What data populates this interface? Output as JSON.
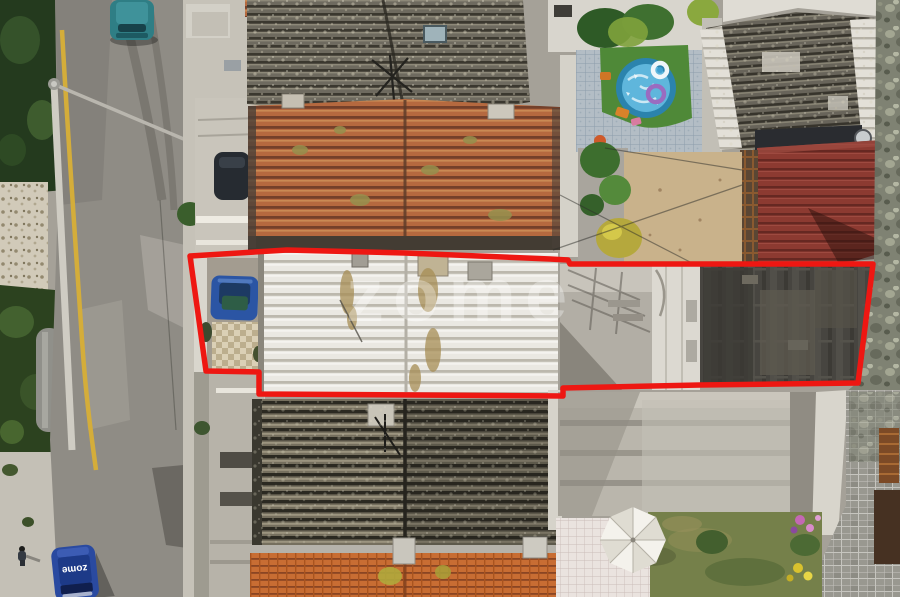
{
  "meta": {
    "kind": "aerial-drone-photo",
    "width": 900,
    "height": 597
  },
  "watermark": {
    "text": "zome",
    "color": "#ffffff",
    "opacity": 0.32
  },
  "branding": {
    "vehicle_label": "zome"
  },
  "boundary": {
    "color": "#ee1712",
    "points": "190,256 287,250 405,253 550,259 568,260 570,264 873,264 858,383 700,385 563,388 563,396 259,394 259,372 206,371"
  },
  "palette": {
    "road": "#8f8c85",
    "yellow_road_line": "#d4ad3a",
    "roof_terracotta": "#b5693f",
    "roof_terracotta_bright": "#c86d33",
    "roof_dark_corrugated": "#5f5b51",
    "roof_white_corrugated": "#eae8e2",
    "roof_charcoal_flat": "#474540",
    "roof_red_metal": "#8c3a31",
    "pool_blue": "#3f9fc8",
    "turf_green": "#4f8938",
    "lawn_green": "#75804a",
    "stone_wall": "#7f8273",
    "granite_pavers": "#999890",
    "teal_car": "#2f7e85",
    "branded_car_blue": "#2a4aa0",
    "boundary_red": "#ee1712"
  },
  "scene": {
    "description": "Aerial drone view of a row of terraced houses with a red property-boundary outline highlighting a white corrugated roof, courtyard and rear flat roof",
    "elements": [
      "street",
      "yellow-road-line",
      "parked-teal-car",
      "zome-branded-car",
      "pedestrian",
      "terracotta-tile-roofs",
      "dark-corrugated-roofs",
      "white-corrugated-roof",
      "charcoal-flat-roof",
      "courtyard-with-blue-car",
      "swimming-pool",
      "pool-floats",
      "garden-turf",
      "patio-umbrella",
      "lawn",
      "flower-beds",
      "red-metal-roof",
      "stone-wall",
      "granite-wall",
      "concrete-terraces",
      "property-boundary-outline",
      "zome-watermark"
    ]
  }
}
